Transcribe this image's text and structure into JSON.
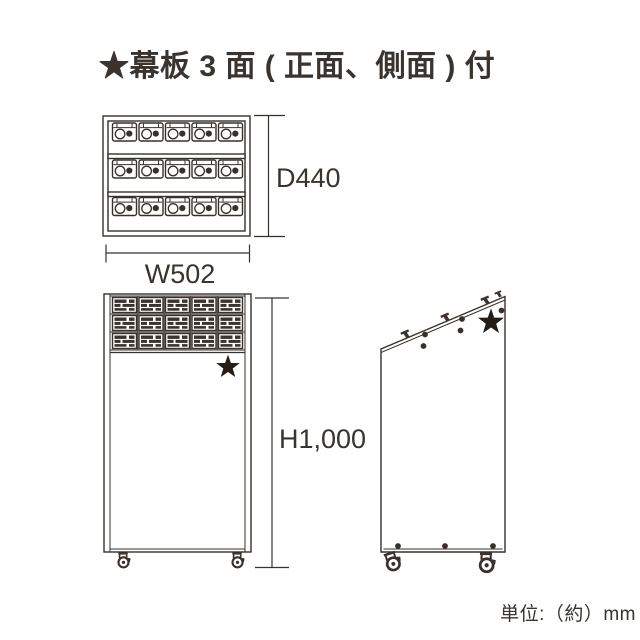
{
  "title": "★幕板 3 面 ( 正面、側面 ) 付",
  "unit_note": "単位:（約）mm",
  "dimensions": {
    "depth_label": "D440",
    "width_label": "W502",
    "height_label": "H1,000"
  },
  "star_glyph": "★",
  "views": {
    "top_view": {
      "name": "top view",
      "rows": 3,
      "slots_per_row": 5
    },
    "front_view": {
      "name": "front view",
      "rows": 3,
      "slots_per_row": 5,
      "casters": 2,
      "star_marks": 1
    },
    "side_view": {
      "name": "side view",
      "hooks": 3,
      "casters": 2,
      "star_marks": 1,
      "bottom_screw_dots": 3
    }
  },
  "colors": {
    "line": "#39302b",
    "text": "#3a332e",
    "star": "#241c16",
    "unit_dark": "#3c332e"
  }
}
